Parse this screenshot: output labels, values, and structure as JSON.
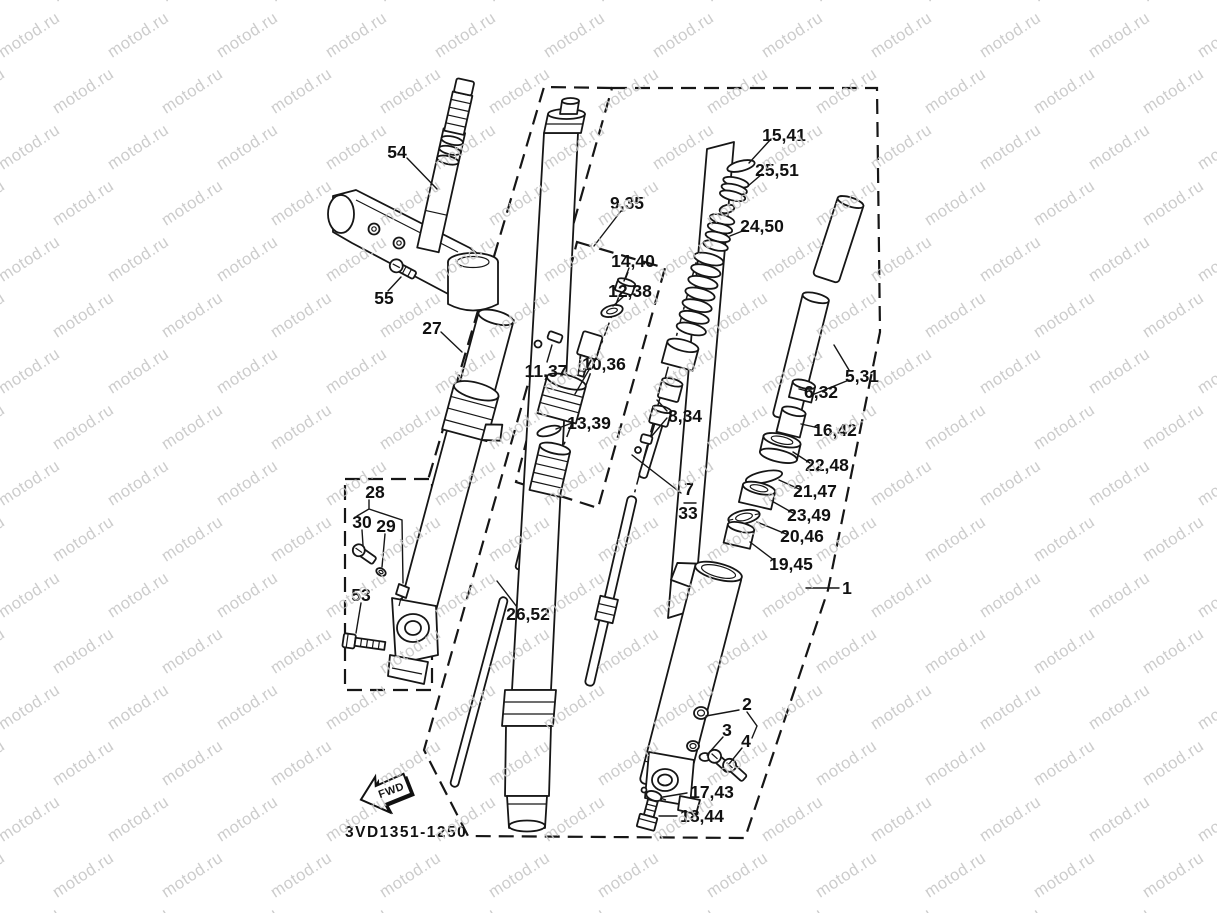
{
  "page": {
    "background": "#ffffff"
  },
  "watermark": {
    "text": "motod.ru",
    "color": "#c7c7c7"
  },
  "diagram": {
    "type": "exploded-parts-diagram",
    "subject": "motorcycle front fork assembly",
    "code": "3VD1351-1250",
    "fwd_label": "FWD",
    "part_labels": {
      "k54": "54",
      "k55": "55",
      "k27": "27",
      "k28": "28",
      "k30": "30",
      "k29": "29",
      "k53": "53",
      "k26_52": "26,52",
      "k9_35": "9,35",
      "k14_40": "14,40",
      "k12_38": "12,38",
      "k11_37": "11,37",
      "k10_36": "10,36",
      "k13_39": "13,39",
      "k8_34": "8,34",
      "k7": "7",
      "k33": "33",
      "k15_41": "15,41",
      "k25_51": "25,51",
      "k24_50": "24,50",
      "k5_31": "5,31",
      "k6_32": "6,32",
      "k16_42": "16,42",
      "k22_48": "22,48",
      "k21_47": "21,47",
      "k23_49": "23,49",
      "k20_46": "20,46",
      "k19_45": "19,45",
      "k1": "1",
      "k2": "2",
      "k3": "3",
      "k4": "4",
      "k17_43": "17,43",
      "k18_44": "18,44"
    }
  }
}
